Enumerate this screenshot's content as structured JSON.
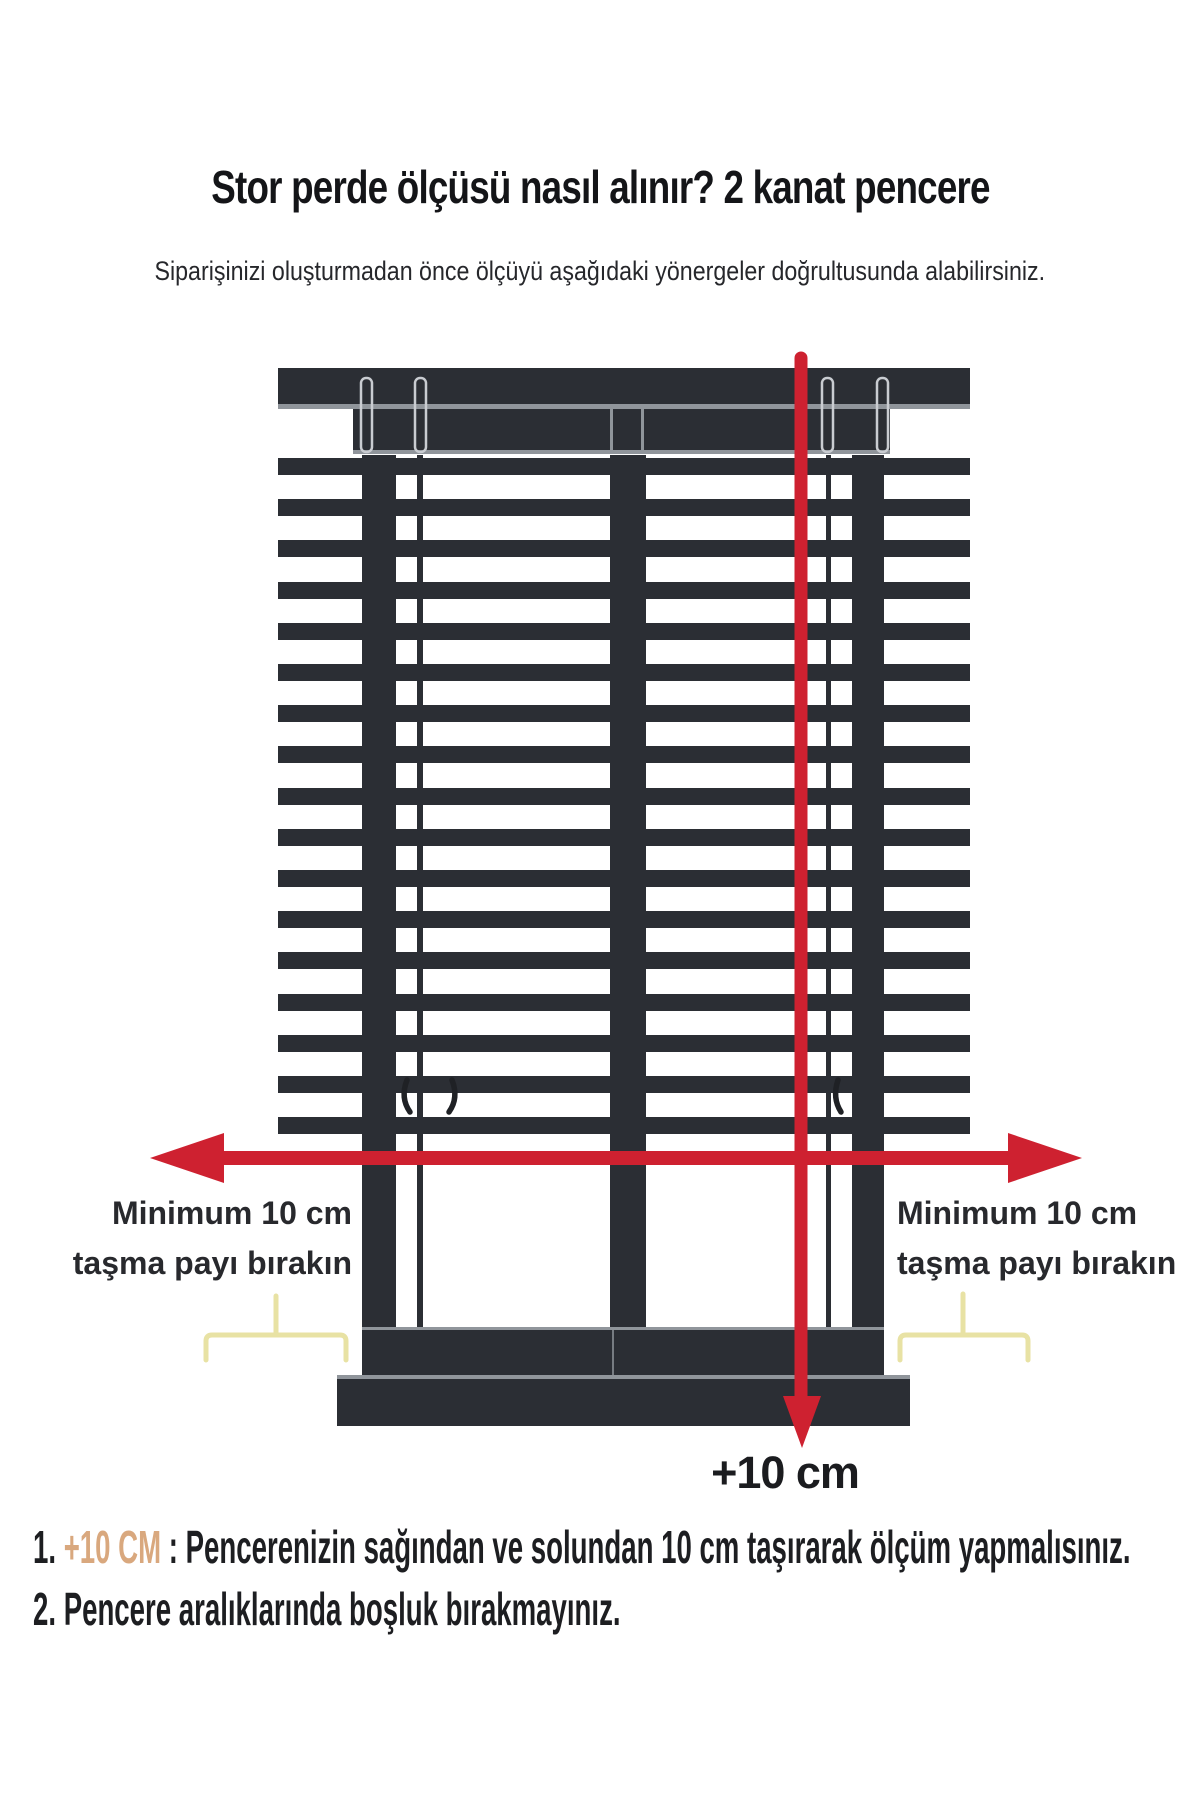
{
  "page": {
    "title": "Stor perde ölçüsü nasıl alınır? 2 kanat pencere",
    "subtitle": "Siparişinizi oluşturmadan önce ölçüyü aşağıdaki yönergeler doğrultusunda alabilirsiniz."
  },
  "diagram": {
    "left_label": {
      "line1": "Minimum 10 cm",
      "line2": "taşma payı bırakın"
    },
    "right_label": {
      "line1": "Minimum 10 cm",
      "line2": "taşma payı bırakın"
    },
    "width_plus_label": "+10 cm"
  },
  "notes": [
    {
      "number": "1.",
      "highlight": " +10 CM ",
      "text": ": Pencerenizin sağından ve solundan 10 cm taşırarak ölçüm yapmalısınız."
    },
    {
      "number": "2.",
      "highlight": "",
      "text": " Pencere aralıklarında boşluk bırakmayınız."
    }
  ],
  "colors": {
    "dark": "#2b2e34",
    "gray_line": "#90959b",
    "red": "#ce2130",
    "bracket_yellow": "#e8e2a4",
    "highlight_orange": "#d9a87e"
  }
}
